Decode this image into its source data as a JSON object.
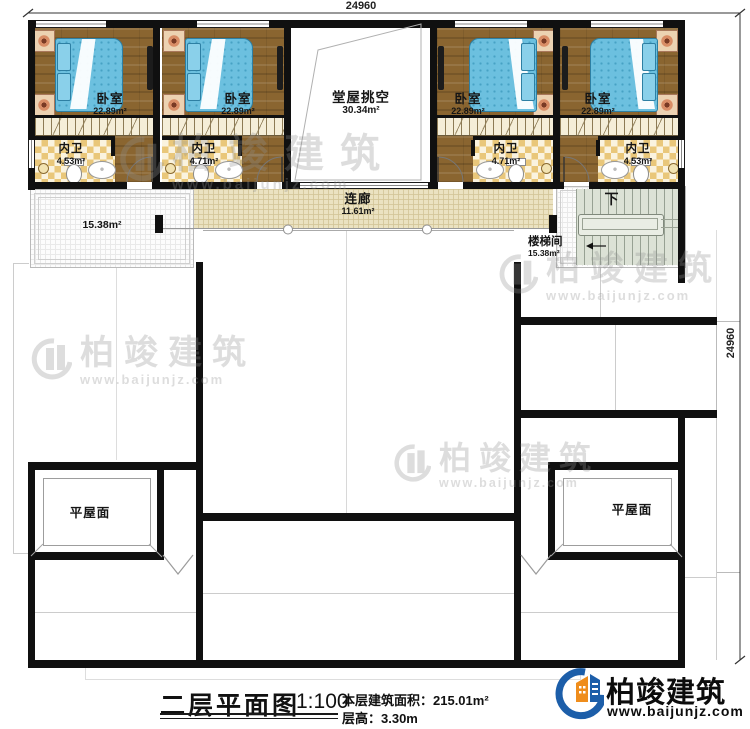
{
  "dimensions": {
    "top": "24960",
    "right": "24960"
  },
  "rooms": {
    "bedroom1": {
      "name": "卧室",
      "area": "22.89m²"
    },
    "bedroom2": {
      "name": "卧室",
      "area": "22.89m²"
    },
    "bedroom3": {
      "name": "卧室",
      "area": "22.89m²"
    },
    "bedroom4": {
      "name": "卧室",
      "area": "22.89m²"
    },
    "bath1": {
      "name": "内卫",
      "area": "4.53m²"
    },
    "bath2": {
      "name": "内卫",
      "area": "4.71m²"
    },
    "bath3": {
      "name": "内卫",
      "area": "4.71m²"
    },
    "bath4": {
      "name": "内卫",
      "area": "4.53m²"
    },
    "hall": {
      "name": "堂屋挑空",
      "area": "30.34m²"
    },
    "corridor": {
      "name": "连廊",
      "area": "11.61m²"
    },
    "terrace": {
      "area": "15.38m²"
    },
    "stairwell": {
      "name": "楼梯间",
      "area": "15.38m²"
    },
    "stairs": {
      "down_label": "下"
    },
    "flat_roof_left": {
      "name": "平屋面"
    },
    "flat_roof_right": {
      "name": "平屋面"
    }
  },
  "title_block": {
    "title": "二层平面图",
    "scale": "1:100",
    "area_line": "本层建筑面积：215.01m²",
    "height_line": "层高：3.30m"
  },
  "brand": {
    "name": "柏竣建筑",
    "url": "www.baijunjz.com"
  },
  "watermark": {
    "name": "柏竣建筑",
    "url": "www.baijunjz.com"
  }
}
